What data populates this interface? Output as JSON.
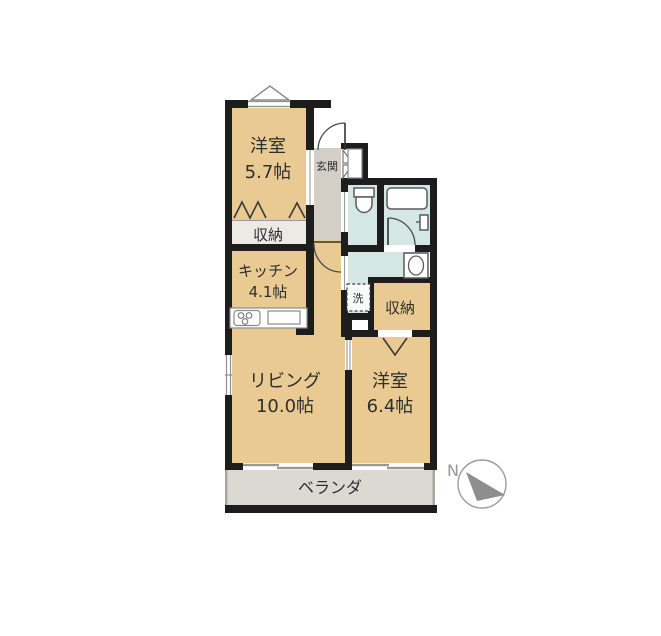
{
  "canvas": {
    "width": 661,
    "height": 636,
    "background": "#ffffff"
  },
  "floorplan": {
    "type": "apartment-floor-plan",
    "rooms": {
      "bedroom1": {
        "name": "洋室",
        "size": "5.7帖"
      },
      "closet1": {
        "name": "収納"
      },
      "kitchen": {
        "name": "キッチン",
        "size": "4.1帖"
      },
      "entrance": {
        "name": "玄関"
      },
      "laundry": {
        "name": "洗"
      },
      "closet2": {
        "name": "収納"
      },
      "living": {
        "name": "リビング",
        "size": "10.0帖"
      },
      "bedroom2": {
        "name": "洋室",
        "size": "6.4帖"
      },
      "veranda": {
        "name": "ベランダ"
      }
    },
    "compass": {
      "label": "N"
    },
    "colors": {
      "room_tan": "#e9ca93",
      "wet_blue": "#d5e7e4",
      "hall_gray": "#d3cfc6",
      "closet_band": "#eceae4",
      "veranda_gray": "#dcd9d2",
      "wall_black": "#1d1d1d",
      "fixture_stroke": "#5a5a5a",
      "compass_gray": "#8e8e8e"
    }
  }
}
